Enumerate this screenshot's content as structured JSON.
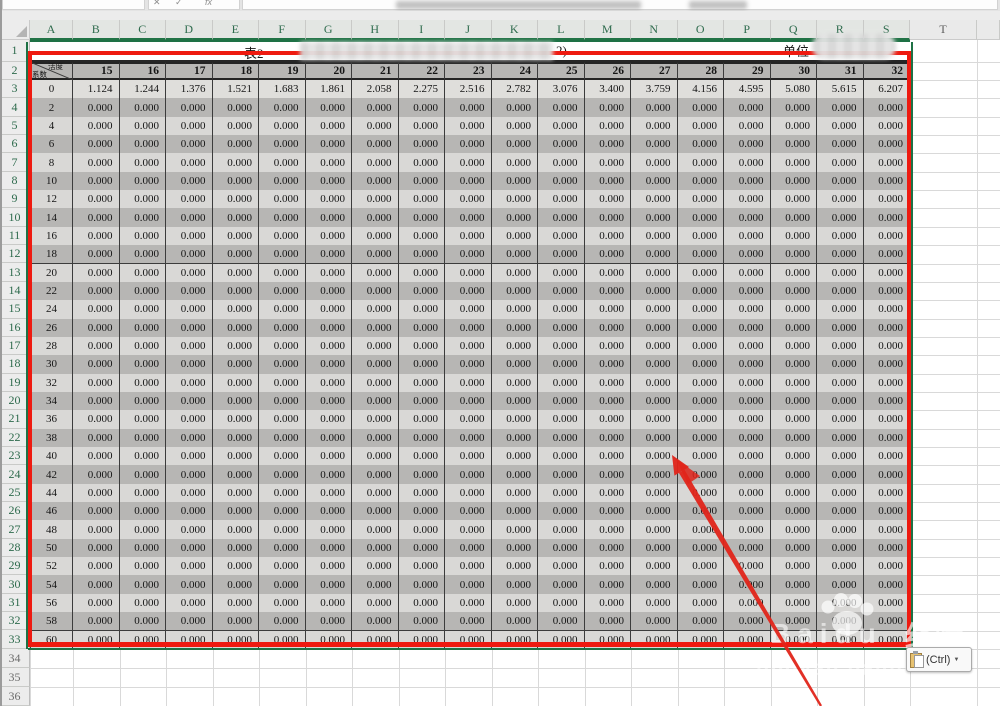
{
  "sheet": {
    "column_letters": [
      "A",
      "B",
      "C",
      "D",
      "E",
      "F",
      "G",
      "H",
      "I",
      "J",
      "K",
      "L",
      "M",
      "N",
      "O",
      "P",
      "Q",
      "R",
      "S",
      "T"
    ],
    "row_numbers": [
      "1",
      "2",
      "3",
      "4",
      "5",
      "6",
      "7",
      "8",
      "9",
      "10",
      "11",
      "12",
      "13",
      "14",
      "15",
      "16",
      "17",
      "18",
      "19",
      "20",
      "21",
      "22",
      "23",
      "24",
      "25",
      "26",
      "27",
      "28",
      "29",
      "30",
      "31",
      "32",
      "33",
      "34",
      "35",
      "36"
    ]
  },
  "formula_bar": {
    "cancel_glyph": "✕",
    "enter_glyph": "✓",
    "fx_label": "fx"
  },
  "title_row": {
    "table_label": "表2",
    "title_suffix": "2)",
    "unit_label": "单位"
  },
  "corner_cell": {
    "top_right": "活度",
    "bottom_left": "系数"
  },
  "grid": {
    "col_headers": [
      "15",
      "16",
      "17",
      "18",
      "19",
      "20",
      "21",
      "22",
      "23",
      "24",
      "25",
      "26",
      "27",
      "28",
      "29",
      "30",
      "31",
      "32"
    ],
    "depths": [
      "0",
      "2",
      "4",
      "6",
      "8",
      "10",
      "12",
      "14",
      "16",
      "18",
      "20",
      "22",
      "24",
      "26",
      "28",
      "30",
      "32",
      "34",
      "36",
      "38",
      "40",
      "42",
      "44",
      "46",
      "48",
      "50",
      "52",
      "54",
      "56",
      "58",
      "60"
    ],
    "first_data_row": [
      "1.124",
      "1.244",
      "1.376",
      "1.521",
      "1.683",
      "1.861",
      "2.058",
      "2.275",
      "2.516",
      "2.782",
      "3.076",
      "3.400",
      "3.759",
      "4.156",
      "4.595",
      "5.080",
      "5.615",
      "6.207"
    ],
    "fill_value": "0.000"
  },
  "paste_options": {
    "label": "(Ctrl)",
    "caret": "▼"
  },
  "watermark": {
    "brand": "Baidu",
    "suffix": "经验",
    "url": "jingyan.baidu.com"
  },
  "colors": {
    "accent_green": "#217346",
    "annotation_red": "#ee1a10",
    "band_dark": "#b7b6b4",
    "band_light": "#d9d8d6"
  }
}
